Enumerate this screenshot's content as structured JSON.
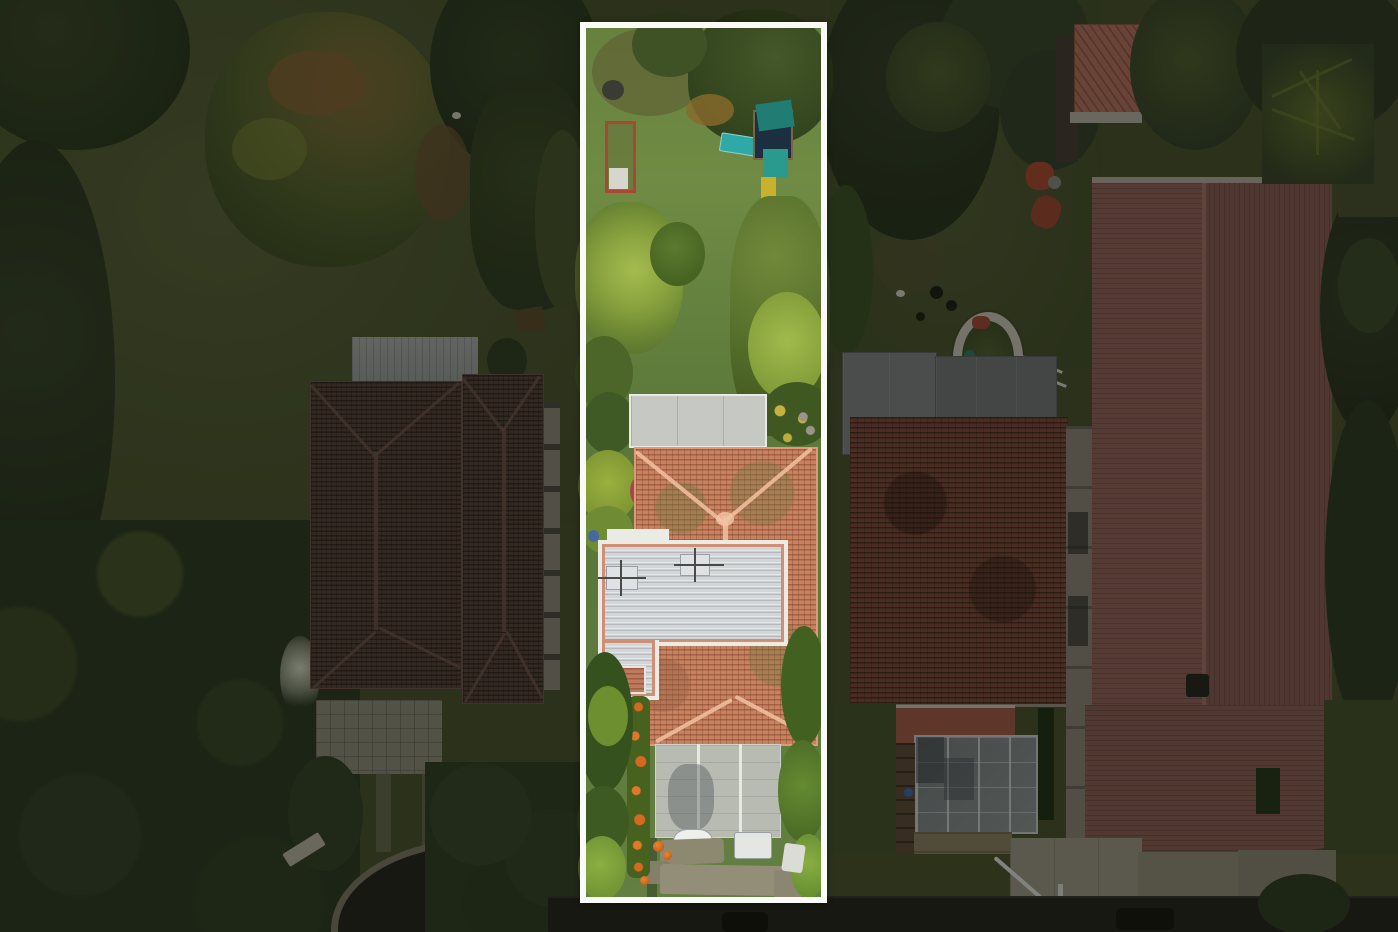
{
  "meta": {
    "type": "aerial-drone-photograph",
    "description": "Top-down aerial view of a residential neighborhood; the center narrow lot is outlined with a white rectangle (real-estate boundary highlight) and areas outside the outline are dimmed",
    "width": 1398,
    "height": 932
  },
  "highlight": {
    "x": 580,
    "y": 22,
    "width": 247,
    "height": 881,
    "border_px": 6
  },
  "colors": {
    "grass_dim": "#4c5630",
    "grass_bright": "#6f8b44",
    "tree_dark": "#2c3a20",
    "tree_mid": "#41552a",
    "tree_yellow": "#9cb448",
    "tree_autumn": "#8a6434",
    "roof_left_tile": "#55423a",
    "roof_left_ridge": "#70584c",
    "metal_roof": "#9fa3a2",
    "roof_center_tile": "#c8825f",
    "roof_center_ridge": "#eebd9c",
    "roof_center_trim": "#e09878",
    "flat_roof_white": "#d3d6d8",
    "flat_roof_frame": "#ebebe5",
    "flat_roof_trim": "#cf8f74",
    "gray_flat_roof": "#c6c8c4",
    "carport_panel": "#b7bab4",
    "roof_right_gray": "#7a7e80",
    "roof_right_brick": "#7c4a3a",
    "roof_right_pink": "#8d6058",
    "shed_coral": "#b5705e",
    "patio_pink": "#a25a48",
    "concrete": "#9c9886",
    "paver": "#8f8a74",
    "road": "#23241d",
    "playground_teal": "#1f7d74",
    "slide_teal": "#2fa8a8",
    "playground_navy": "#1c2f40",
    "seat_yellow": "#c8b12f",
    "frame_red": "#aa4733",
    "flower_orange": "#d4691f",
    "white_obj": "#e2e4de",
    "highlight": "#fafaf7",
    "dim": "rgba(8,10,5,0.44)"
  },
  "scene": {
    "highlighted_lot": [
      "backyard-lawn",
      "playground-slide",
      "raised-garden-bed",
      "garden-trees",
      "gray-flat-roof",
      "terracotta-tile-roof",
      "white-flat-roof",
      "carport",
      "driveway-pavers",
      "orange-flower-border",
      "hedges",
      "white-car",
      "water-tank"
    ],
    "left_property": [
      "dark-tile-hip-roof-house",
      "metal-roof-annex",
      "paver-patio",
      "curved-asphalt-driveway",
      "mature-trees",
      "lawn-field"
    ],
    "right_properties": [
      "gray-metal-roof",
      "brick-tile-roof-house",
      "glass-carport",
      "round-planter",
      "coral-roof-shed",
      "large-pink-roof-house",
      "concrete-driveways",
      "white-handrail"
    ],
    "street": [
      "asphalt-road",
      "parked-car-shadows",
      "grass-verge",
      "tree-overhang"
    ]
  }
}
